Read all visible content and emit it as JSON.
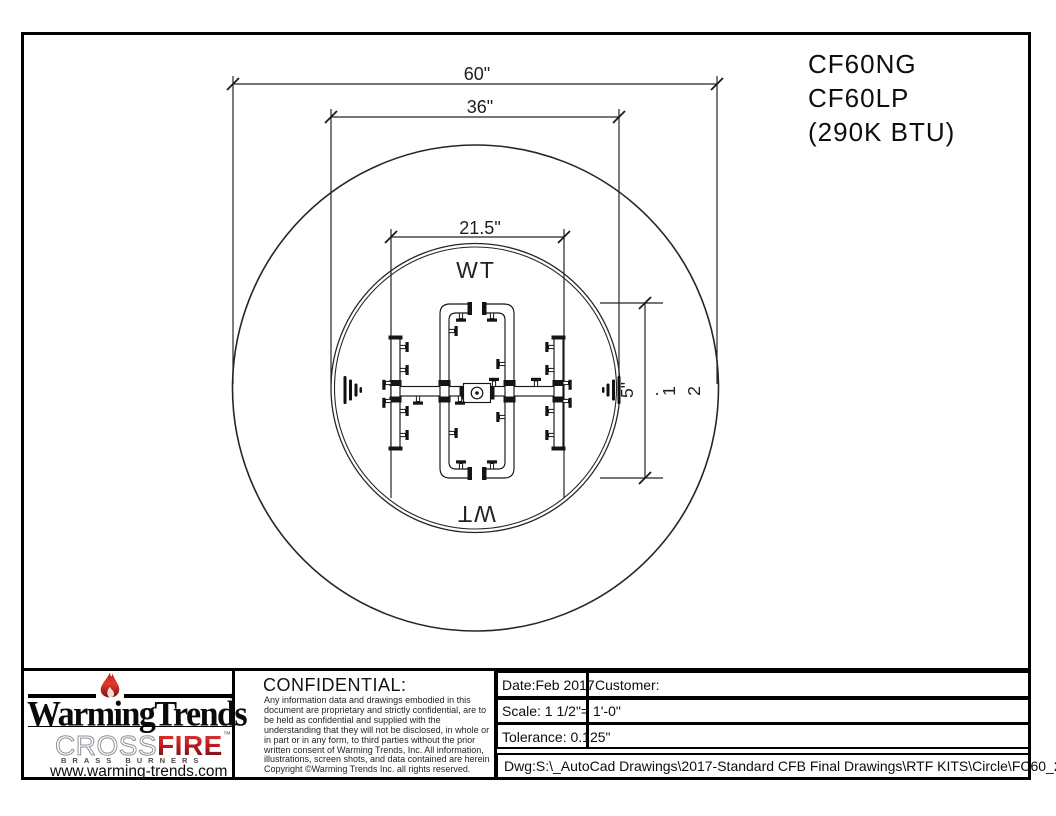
{
  "product": {
    "model_ng": "CF60NG",
    "model_lp": "CF60LP",
    "btu": "(290K BTU)"
  },
  "drawing": {
    "dim_outer_diameter": "60\"",
    "dim_inner_diameter": "36\"",
    "dim_burner_width": "21.5\"",
    "dim_burner_height": "21.5\"",
    "dim_burner_height_chars": [
      "5\"",
      ".",
      "1",
      "2"
    ],
    "brand_mark_top": "WT",
    "brand_mark_bottom": "WT"
  },
  "title_block": {
    "logo": {
      "wordmark": "WarmingTrends",
      "registered": "®",
      "crossfire_cross": "CROSS",
      "crossfire_fire": "FIRE",
      "trademark": "™",
      "sub_brand": "BRASS BURNERS",
      "website": "www.warming-trends.com"
    },
    "confidential": {
      "heading": "CONFIDENTIAL:",
      "body": "Any information data and drawings embodied in this document are proprietary and strictly confidential, are to be held as confidential and supplied with the understanding that they will not be disclosed, in whole or in part or in any form, to third parties without the prior written consent of Warming Trends, Inc. All information, illustrations, screen shots, and data contained are herein Copyright ©Warming Trends Inc. all rights reserved."
    },
    "fields": {
      "date": "Date:Feb 2017",
      "customer": "Customer:",
      "scale": "Scale: 1 1/2\"= 1'-0\"",
      "tolerance": "Tolerance: 0.125\"",
      "dwg_path": "Dwg:S:\\_AutoCad Drawings\\2017-Standard CFB Final Drawings\\RTF KITS\\Circle\\FC60_290K"
    }
  },
  "colors": {
    "accent_red": "#c3161c",
    "line": "#1f1f1f"
  }
}
